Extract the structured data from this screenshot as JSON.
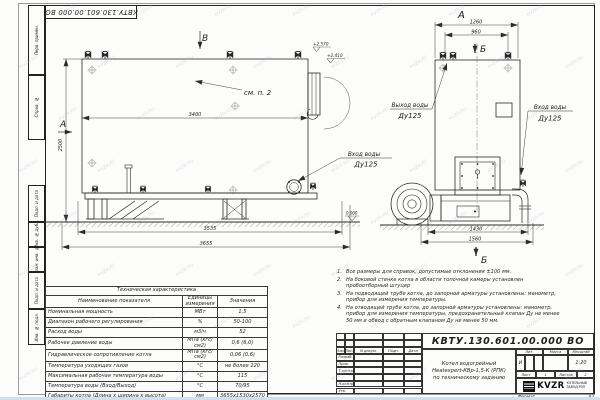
{
  "watermark": {
    "text": "KVZR.RU"
  },
  "doc": {
    "stamp_number": "КВТУ.130.601.00.000  ВО"
  },
  "frame": {
    "margin_labels": [
      "Перв. примен.",
      "Справ. №",
      "Подп. и дата",
      "Инв. № дубл.",
      "Взам. инв. №",
      "Подп. и дата",
      "Инв. № подл."
    ]
  },
  "views": {
    "side": {
      "view_label_top": "В",
      "view_label_side": "А",
      "see_note": "см. п. 2",
      "dim_inner": "3400",
      "dim_height": "2500",
      "dim_frame": "3535",
      "dim_total": "3655",
      "elev_top": "+2.570",
      "elev_mid": "+2.410",
      "elev_zero": "0.000",
      "inlet_title": "Вход воды",
      "inlet_dn": "Ду125"
    },
    "front": {
      "view_label": "А",
      "section_label_top": "Б",
      "section_label_bottom": "Б",
      "dim_top_outer": "1260",
      "dim_top_inner": "960",
      "dim_bottom_inner": "1430",
      "dim_bottom_outer": "1560",
      "outlet_title": "Выход воды",
      "outlet_dn": "Ду125",
      "inlet_title": "Вход воды",
      "inlet_dn": "Ду125"
    }
  },
  "table": {
    "title": "Техническая характеристика",
    "headers": [
      "Наименование показателя",
      "Единицы измерения",
      "Значения"
    ],
    "rows": [
      [
        "Номинальная мощность",
        "МВт",
        "1,5"
      ],
      [
        "Диапазон рабочего регулирования",
        "%",
        "50-100"
      ],
      [
        "Расход воды",
        "м3/ч",
        "52"
      ],
      [
        "Рабочее давление воды",
        "МПа (кгс/см2)",
        "0,6 (6,0)"
      ],
      [
        "Гидравлическое сопротивление котла",
        "МПа (кгс/см2)",
        "0,06 (0,6)"
      ],
      [
        "Температура уходящих газов",
        "°С",
        "не более 220"
      ],
      [
        "Максимальная рабочая температура воды",
        "°С",
        "115"
      ],
      [
        "Температура воды (Вход/Выход)",
        "°С",
        "70/95"
      ],
      [
        "Габариты котла (Длина х ширина х высота)",
        "мм",
        "3655х1530х2570"
      ]
    ]
  },
  "notes": [
    {
      "num": "1.",
      "text": "Все размеры для справок, допустимые отклонения ±100 мм."
    },
    {
      "num": "2.",
      "text": "На боковой стенке котла в области топочной камеры установлен пробоотборный штуцер"
    },
    {
      "num": "3.",
      "text": "На подводящей трубе котла, до запорной арматуры установлены: манометр, прибор для измерения температуры."
    },
    {
      "num": "4.",
      "text": "На отводящей трубе котла, до запорной арматуры установлены: манометр, прибор для измерения температуры, предохранительный клапан Ду не менее 50 мм и обвод с обратным клапаном Ду не менее 50 мм."
    }
  ],
  "title_block": {
    "number": "КВТУ.130.601.00.000  ВО",
    "name_lines": [
      "Котел водогрейный",
      "Heatexpert-КВр-1,5-К (РПК)",
      "по техническому заданию"
    ],
    "col_headers": [
      "Изм.",
      "Лист",
      "N докум.",
      "Подп.",
      "Дата"
    ],
    "row_labels": [
      "Разраб.",
      "Пров.",
      "Т.контр.",
      "",
      "Н.контр.",
      "Утв."
    ],
    "lit_header": "Лит.",
    "lit_value": "И",
    "mass_header": "Масса",
    "scale_header": "Масштаб",
    "scale_value": "1:20",
    "sheet_label": "Лист",
    "sheet_value": "1",
    "sheets_label": "Листов",
    "sheets_value": "2",
    "logo_text": "KVZR",
    "logo_caption_lines": [
      "КОТЕЛЬНЫЙ",
      "ЗАВОД РЭП"
    ],
    "format_label": "Формат",
    "format_value": "А3"
  }
}
